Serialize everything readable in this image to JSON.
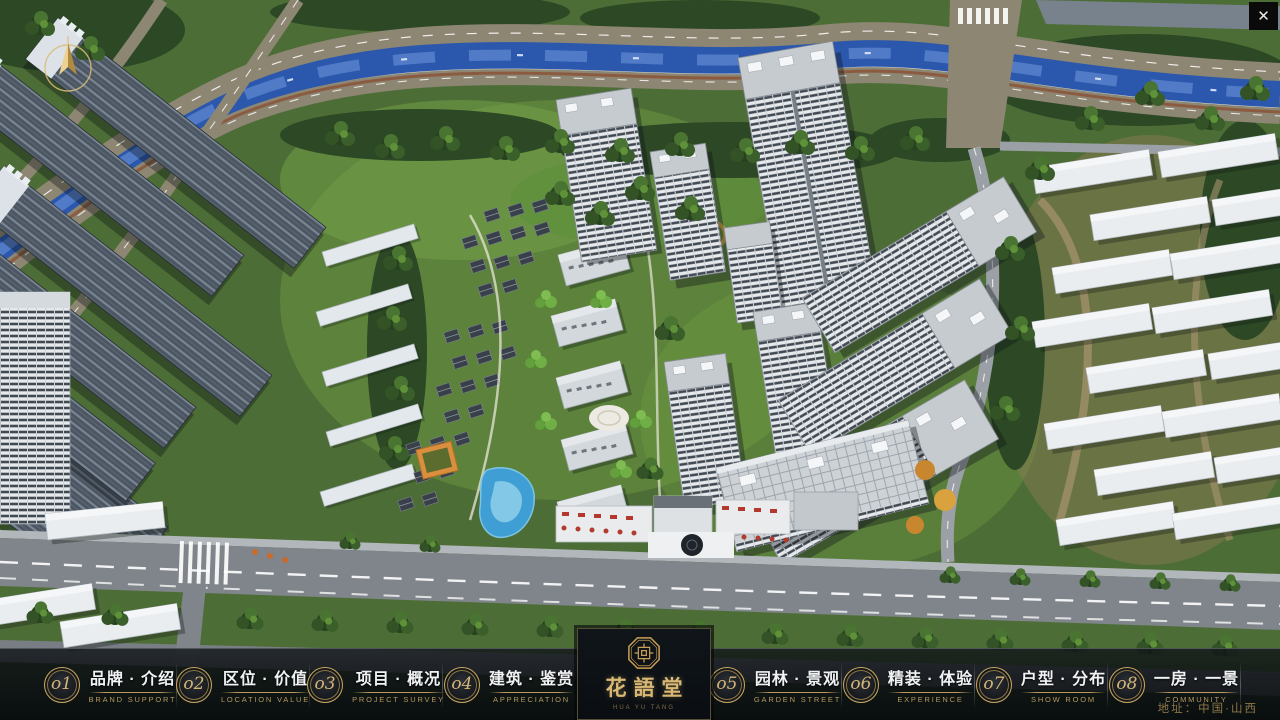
{
  "window": {
    "close_glyph": "✕"
  },
  "logo": {
    "title": "花語堂",
    "caption": "HUA YU TANG"
  },
  "menu": {
    "items": [
      {
        "num": "o1",
        "title": "品牌 · 介绍",
        "subtitle": "BRAND SUPPORT"
      },
      {
        "num": "o2",
        "title": "区位 · 价值",
        "subtitle": "LOCATION VALUE"
      },
      {
        "num": "o3",
        "title": "项目 · 概况",
        "subtitle": "PROJECT SURVEY"
      },
      {
        "num": "o4",
        "title": "建筑 · 鉴赏",
        "subtitle": "APPRECIATION"
      },
      {
        "num": "o5",
        "title": "园林 · 景观",
        "subtitle": "GARDEN STREET"
      },
      {
        "num": "o6",
        "title": "精装 · 体验",
        "subtitle": "EXPERIENCE"
      },
      {
        "num": "o7",
        "title": "户型 · 分布",
        "subtitle": "SHOW ROOM"
      },
      {
        "num": "o8",
        "title": "一房 · 一景",
        "subtitle": "COMMUNITY"
      }
    ]
  },
  "footer": {
    "address": "地址：中国·山西"
  },
  "colors": {
    "accent_gold": "#c9a85f",
    "menu_text": "#f0f2f4",
    "menu_caption": "#b49a5e",
    "bar_background": "#0c1014",
    "logo_gold": "#d9b873",
    "address_gold": "#8d7748",
    "river_blue": "#2b57ad",
    "foliage_green": "#3a5f2b",
    "building_white": "#e9edf0",
    "road_tan": "#8d8672",
    "road_gray": "#7f858a"
  }
}
